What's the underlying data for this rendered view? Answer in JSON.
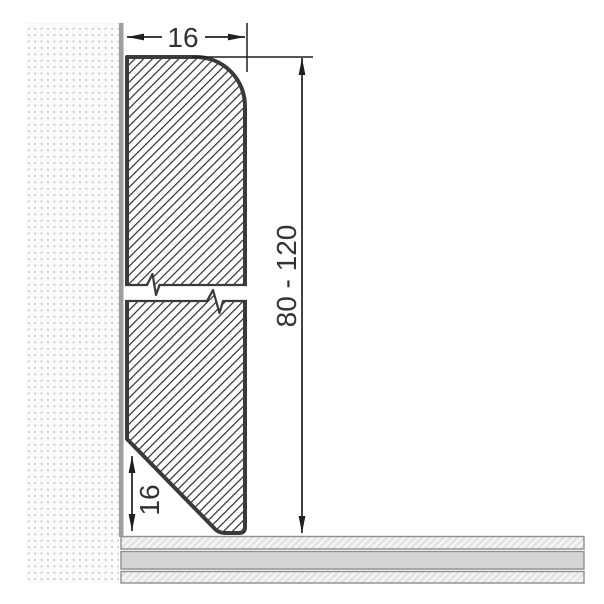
{
  "diagram": {
    "labels": {
      "width": "16",
      "height_range": "80 - 120",
      "chamfer_height": "16"
    },
    "colors": {
      "background": "#ffffff",
      "outline": "#3a3a3a",
      "hatch_line": "#2f2f2f",
      "dimension": "#1f1f1f",
      "text": "#333333",
      "wall_edge": "#9e9e9e",
      "wall_dot": "#c8c8c8",
      "wall_bg": "#fcfcfc",
      "floor_border": "#8f8f8f",
      "floor_fill": "#d5d5d5",
      "floor_hatch_bg": "#e4e4e4",
      "floor_hatch_line": "#f8f8f8"
    }
  }
}
